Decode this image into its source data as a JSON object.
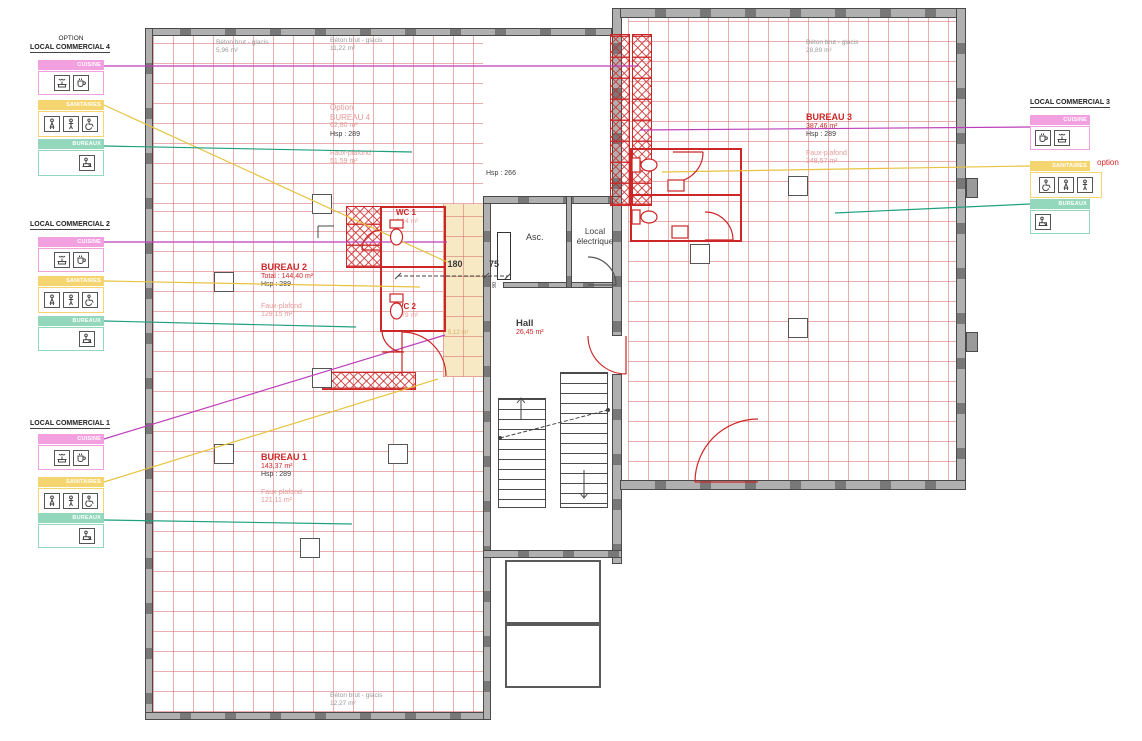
{
  "plan_type": "architectural-floor-plan",
  "rooms": {
    "bureau4": {
      "option": "Option",
      "name": "BUREAU 4",
      "area": "62,80 m²",
      "hsp": "Hsp : 289",
      "fp": "Faux-plafond",
      "fp_area": "51,59 m²"
    },
    "bureau2": {
      "name": "BUREAU 2",
      "total": "Total : 144,40 m²",
      "hsp": "Hsp : 289",
      "fp": "Faux-plafond",
      "fp_area": "129,15 m²"
    },
    "bureau1": {
      "name": "BUREAU 1",
      "area": "143,37 m²",
      "hsp": "Hsp : 289",
      "fp": "Faux-plafond",
      "fp_area": "121,11 m²"
    },
    "bureau3": {
      "name": "BUREAU 3",
      "area": "387,46 m²",
      "hsp": "Hsp : 289",
      "fp": "Faux-plafond",
      "fp_area": "348,57 m²"
    },
    "wc1": {
      "name": "WC 1",
      "area": "3,14 m²"
    },
    "wc2": {
      "name": "WC 2",
      "area": "2,79 m²"
    },
    "hall": {
      "name": "Hall",
      "area": "26,45 m²"
    },
    "asc": {
      "name": "Asc."
    },
    "local_electrique": {
      "line1": "Local",
      "line2": "électrique"
    },
    "corridor": {
      "area": "5,12 m²"
    },
    "hsp_note": "Hsp : 266"
  },
  "dimensions": {
    "d180": "180",
    "d75": "75",
    "d90": "90"
  },
  "beton": [
    {
      "label": "Béton brut - glacis",
      "area": "5,96 m²"
    },
    {
      "label": "Béton brut - glacis",
      "area": "11,22 m²"
    },
    {
      "label": "Béton brut - glacis",
      "area": "28,89 m²"
    },
    {
      "label": "Béton brut - glacis",
      "area": "12,27 m²"
    }
  ],
  "legends": [
    {
      "pretitle": "OPTION",
      "title": "LOCAL COMMERCIAL 4",
      "cuisine": "CUISINE",
      "sanitaires": "SANITAIRES",
      "bureaux": "BUREAUX"
    },
    {
      "title": "LOCAL COMMERCIAL 2",
      "cuisine": "CUISINE",
      "sanitaires": "SANITAIRES",
      "bureaux": "BUREAUX"
    },
    {
      "title": "LOCAL COMMERCIAL 1",
      "cuisine": "CUISINE",
      "sanitaires": "SANITAIRES",
      "bureaux": "BUREAUX"
    },
    {
      "title": "LOCAL COMMERCIAL 3",
      "cuisine": "CUISINE",
      "sanitaires": "SANITAIRES",
      "bureaux": "BUREAUX",
      "option_note": "option"
    }
  ],
  "legend_icons": {
    "cuisine": [
      "sink-icon",
      "coffee-machine-icon"
    ],
    "sanitaires": [
      "woman-icon",
      "man-icon",
      "accessible-icon"
    ],
    "bureaux": [
      "desk-person-icon"
    ]
  },
  "colors": {
    "cuisine_bar": "#f2a0e0",
    "sanitaires_bar": "#f5d570",
    "bureaux_bar": "#93d7bd",
    "leader_cuisine": "#bb3fbb",
    "leader_sanitaires": "#e7c33f",
    "leader_bureaux": "#1fa07f",
    "plan_red": "#cc2626",
    "grid_red": "#d66e6e",
    "wall_gray": "#b0b0b0",
    "corridor_yellow": "#f6e9c4"
  }
}
